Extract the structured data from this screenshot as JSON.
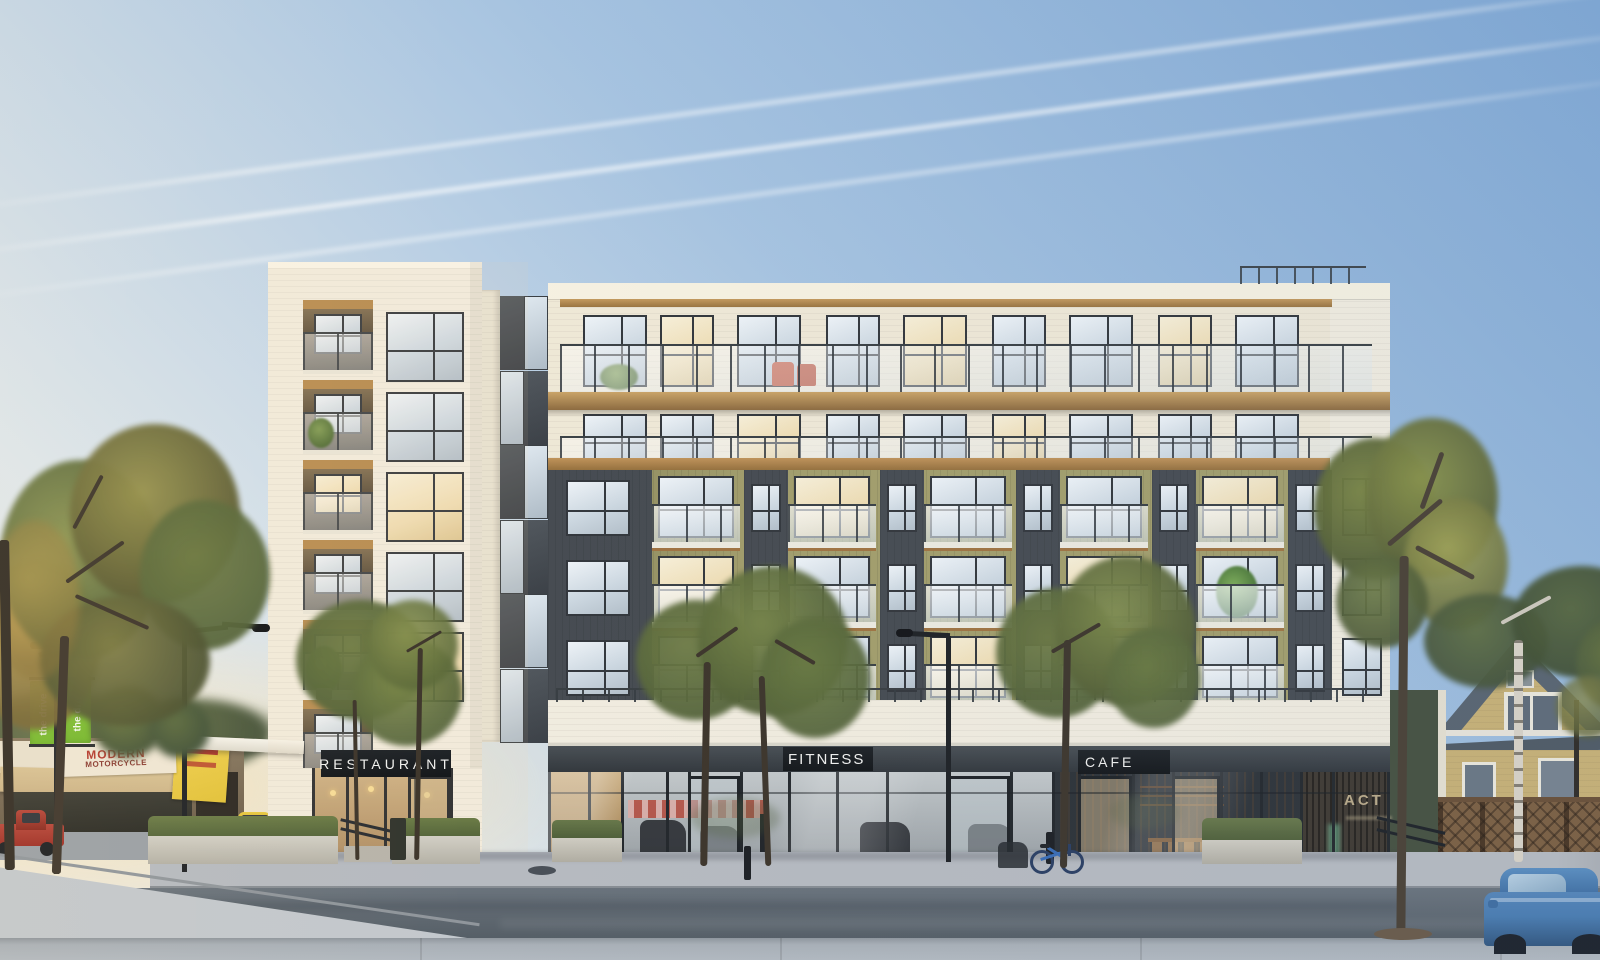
{
  "signs": {
    "restaurant": "RESTAURANT",
    "fitness": "FITNESS",
    "cafe": "CAFE",
    "lobby": "ACT"
  },
  "street": {
    "banner_word1": "the",
    "banner_word2": "drive",
    "shop_sign_line1": "MODERN",
    "shop_sign_line2": "MOTORCYCLE"
  },
  "colors": {
    "sky_top": "#7fa7d3",
    "sky_mid": "#a6c3e0",
    "sky_horizon": "#dfe7ec",
    "cream_siding": "#efe8d6",
    "cream_parapet": "#f6f1e1",
    "wood_trim": "#b5894e",
    "olive_panel": "#a39e6c",
    "charcoal_panel": "#474c52",
    "white_brick": "#f1ecdf",
    "window_frame": "#34383d",
    "glass_light": "#dde7ef",
    "glass_warm": "#f2e7c8",
    "fascia_dark": "#383d42",
    "sign_text": "#f0f0ee",
    "banner_green": "#76b82f",
    "awning_beige": "#cdb488",
    "shop_sign_red": "#b43a2e",
    "taxi_yellow": "#e2c23a",
    "truck_red": "#9e2f26",
    "car_blue": "#4a7cb0",
    "house_tan": "#c8b175",
    "roof_gray": "#59646f",
    "fence_brown": "#7c5f41",
    "road_gray": "#5f6871",
    "sidewalk_gray": "#b6bac0",
    "plaza_gray": "#c3c8cd",
    "foliage_green": "#6d7a43",
    "foliage_warm": "#a08b49",
    "trunk_brown": "#3e362c"
  }
}
